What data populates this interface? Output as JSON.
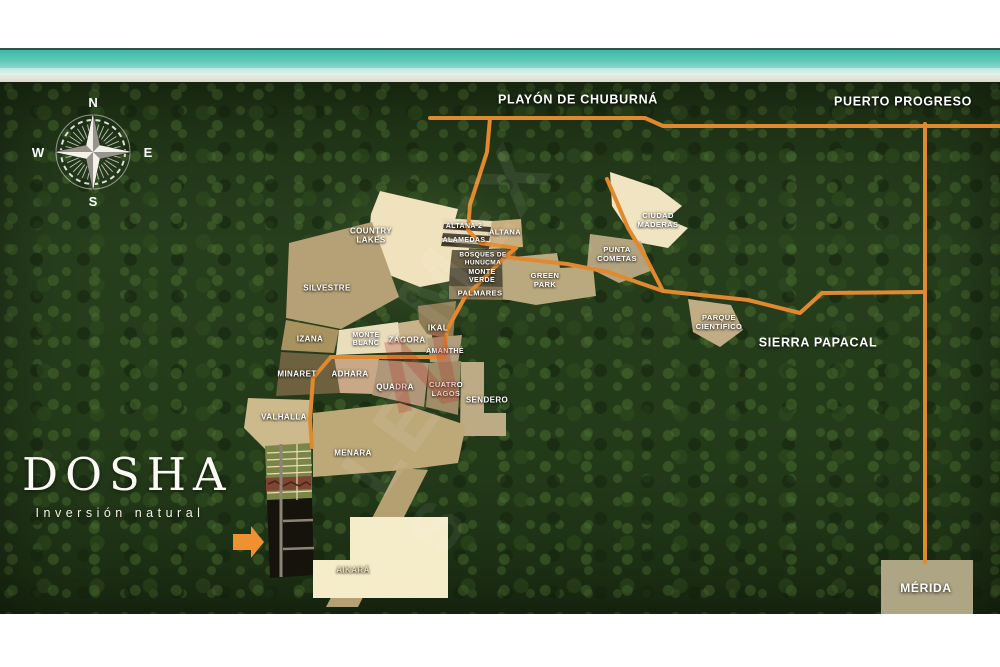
{
  "title": "DOSHA Inversión natural - master plan location map",
  "colors": {
    "road": "#e2892f",
    "arrow": "#ef9130",
    "label": "#ffffff",
    "ocean": "#4fc0b2",
    "forest": "#243a1b",
    "white_band": "#ffffff"
  },
  "compass": {
    "n": "N",
    "e": "E",
    "s": "S",
    "w": "W"
  },
  "logo": {
    "title": "DOSHA",
    "subtitle": "Inversión natural"
  },
  "region_labels": [
    {
      "id": "playon-de-chuburna",
      "text": "PLAYÓN DE CHUBURNÁ",
      "x": 578,
      "y": 100
    },
    {
      "id": "puerto-progreso",
      "text": "PUERTO PROGRESO",
      "x": 903,
      "y": 102
    },
    {
      "id": "sierra-papacal",
      "text": "SIERRA PAPACAL",
      "x": 818,
      "y": 343
    },
    {
      "id": "merida",
      "text": "MÉRIDA",
      "x": 926,
      "y": 588,
      "size": 12
    }
  ],
  "parcels": [
    {
      "id": "country-lakes",
      "lines": [
        "COUNTRY",
        "LAKES"
      ],
      "x": 371,
      "y": 236,
      "size": 8,
      "fill": "#efe2bd",
      "points": "380,191 458,209 451,235 469,248 466,278 420,287 366,266 371,214"
    },
    {
      "id": "altana-lots-base",
      "fill": "#e9dcba",
      "points": "443,218 492,221 490,249 441,247"
    },
    {
      "id": "altana-lot-row-1",
      "fill": "#46402e",
      "points": "444,224 491,227 490,232 443,229"
    },
    {
      "id": "altana-lot-row-2",
      "fill": "#46402e",
      "points": "443,233 490,236 489,241 442,238"
    },
    {
      "id": "altana-lot-row-3",
      "fill": "#46402e",
      "points": "442,242 490,245 489,249 441,246"
    },
    {
      "id": "altana-2",
      "text": "ALTANA 2",
      "x": 464,
      "y": 227,
      "size": 7
    },
    {
      "id": "alamedas",
      "text": "ALAMEDAS",
      "x": 464,
      "y": 241,
      "size": 7
    },
    {
      "id": "altana",
      "text": "ALTANA",
      "x": 505,
      "y": 233,
      "size": 7.5,
      "fill": "#c8ae7e",
      "points": "492,221 521,219 523,247 490,249"
    },
    {
      "id": "bosques-de-hunucma",
      "lines": [
        "BOSQUES DE",
        "HUNUCMA"
      ],
      "x": 483,
      "y": 259,
      "size": 6.5,
      "fill": "#6b5f45",
      "points": "452,250 516,250 514,268 450,268"
    },
    {
      "id": "monte-verde",
      "lines": [
        "MONTE",
        "VERDE"
      ],
      "x": 482,
      "y": 277,
      "size": 7,
      "fill": "#57503c",
      "points": "450,268 514,268 512,287 449,286"
    },
    {
      "id": "palmares",
      "text": "PALMARES",
      "x": 480,
      "y": 294,
      "size": 7.5,
      "fill": "#8a7b57",
      "points": "449,286 512,287 511,300 449,299"
    },
    {
      "id": "green-park",
      "lines": [
        "GREEN",
        "PARK"
      ],
      "x": 545,
      "y": 281,
      "size": 7.5,
      "fill": "#baa87e",
      "points": "502,258 557,253 560,268 593,266 596,296 536,305 503,299"
    },
    {
      "id": "ciudad-maderas",
      "lines": [
        "CIUDAD",
        "MADERAS"
      ],
      "x": 658,
      "y": 221,
      "size": 7.5,
      "fill": "#f0e4c2",
      "points": "610,172 658,188 682,206 667,219 688,228 668,248 636,242 612,206"
    },
    {
      "id": "punta-cometas",
      "lines": [
        "PUNTA",
        "COMETAS"
      ],
      "x": 617,
      "y": 255,
      "size": 7.5,
      "fill": "#c6b28c",
      "opacity": 0.88,
      "points": "590,234 641,241 653,270 619,283 587,267"
    },
    {
      "id": "parque-cientifico",
      "lines": [
        "PARQUE",
        "CIENTÍFICO"
      ],
      "x": 719,
      "y": 323,
      "size": 7.5,
      "fill": "#c1ad85",
      "points": "688,299 731,305 743,330 720,347 693,332"
    },
    {
      "id": "silvestre",
      "text": "SILVESTRE",
      "x": 327,
      "y": 288,
      "size": 8,
      "fill": "#b5a175",
      "points": "289,243 372,222 399,297 341,329 286,318"
    },
    {
      "id": "izana",
      "text": "IZANA",
      "x": 310,
      "y": 339,
      "size": 8,
      "fill": "#a8935f",
      "points": "286,320 339,330 334,353 281,350"
    },
    {
      "id": "monte-blanc",
      "lines": [
        "MONTE",
        "BLANC"
      ],
      "x": 366,
      "y": 340,
      "size": 7,
      "fill": "#e9ddbc",
      "points": "339,330 398,322 402,352 336,355"
    },
    {
      "id": "zagora",
      "text": "ZÁGORA",
      "x": 407,
      "y": 340,
      "size": 8,
      "fill": "#c7b28a",
      "points": "398,323 431,318 433,352 402,352"
    },
    {
      "id": "ikal",
      "text": "IKAL",
      "x": 438,
      "y": 328,
      "size": 8,
      "fill": "#8d7c55",
      "points": "418,306 456,301 453,340 427,334 419,322"
    },
    {
      "id": "amanthe",
      "text": "AMANTHÉ",
      "x": 445,
      "y": 352,
      "size": 7,
      "fill": "#b19e7c",
      "points": "427,338 462,335 458,364 430,362"
    },
    {
      "id": "minaret",
      "text": "MINARET",
      "x": 297,
      "y": 374,
      "size": 8,
      "fill": "#6e6140",
      "points": "281,352 334,355 340,393 276,396"
    },
    {
      "id": "adhara",
      "text": "ADHARA",
      "x": 350,
      "y": 374,
      "size": 8,
      "fill": "#c8a886",
      "points": "334,356 379,359 374,394 340,393"
    },
    {
      "id": "quadra",
      "text": "QUADRA",
      "x": 395,
      "y": 387,
      "size": 8,
      "fill": "#b0977a",
      "points": "379,360 429,363 424,407 372,395"
    },
    {
      "id": "cuatro-lagos",
      "lines": [
        "CUATRO",
        "LAGOS"
      ],
      "x": 446,
      "y": 390,
      "size": 7.5,
      "fill": "#a18d68",
      "points": "429,363 461,361 458,415 426,407"
    },
    {
      "id": "sendero",
      "text": "SENDERO",
      "x": 487,
      "y": 400,
      "size": 8,
      "fill": "#bcab85",
      "points": "461,362 484,362 484,413 506,413 506,436 460,436"
    },
    {
      "id": "valhalla",
      "text": "VALHALLA",
      "x": 284,
      "y": 417,
      "size": 8,
      "fill": "#ccb98c",
      "points": "248,398 310,400 312,447 268,452 244,428"
    },
    {
      "id": "menara",
      "text": "MENARA",
      "x": 353,
      "y": 453,
      "size": 8,
      "fill": "#bda878",
      "points": "313,413 400,403 466,425 458,463 404,470 313,477"
    },
    {
      "id": "menara-tail",
      "fill": "#b5a071",
      "points": "398,468 428,470 358,607 326,607"
    },
    {
      "id": "dosha-green-lots",
      "fill": "#7b8548",
      "points": "265,446 311,443 312,498 267,500"
    },
    {
      "id": "dosha-red-band",
      "fill": "#7d4532",
      "points": "266,478 311,476 311,489 266,491"
    },
    {
      "id": "dosha-black-lots",
      "fill": "#16130d",
      "points": "267,500 312,498 314,575 270,578"
    },
    {
      "id": "aikara",
      "text": "AIKARÁ",
      "x": 353,
      "y": 570,
      "size": 8,
      "color": "#ead9ae",
      "fill": "#f5ecca",
      "points": "350,517 448,517 448,598 313,598 313,560 350,560"
    },
    {
      "id": "merida-box",
      "fill": "#aea584",
      "points": "881,560 973,560 973,614 881,614"
    }
  ],
  "roads": [
    {
      "points": "430,118 645,118 663,126 1000,126",
      "w": 4
    },
    {
      "points": "925,124 925,562",
      "w": 4
    },
    {
      "points": "490,118 487,152 470,205 468,230 480,243 516,248",
      "w": 4
    },
    {
      "points": "607,179 628,228 646,258 663,291",
      "w": 4
    },
    {
      "points": "516,248 505,257 465,297 447,330 444,357 331,357 313,378 310,420 312,447",
      "w": 4
    },
    {
      "points": "505,257 567,264 608,272 663,291 748,300 800,313 822,293 924,292",
      "w": 4
    }
  ],
  "detail_lines": [
    {
      "points": "267,453 311,451",
      "stroke": "#e9deb6",
      "w": 1.2
    },
    {
      "points": "267,460 311,458",
      "stroke": "#e9deb6",
      "w": 1.2
    },
    {
      "points": "267,467 312,465",
      "stroke": "#e9deb6",
      "w": 1.2
    },
    {
      "points": "267,474 312,472",
      "stroke": "#e9deb6",
      "w": 1.2
    },
    {
      "points": "267,493 312,491",
      "stroke": "#e9deb6",
      "w": 1.2
    },
    {
      "points": "297,444 297,500",
      "stroke": "#e9deb6",
      "w": 1.2
    },
    {
      "points": "268,484 275,481 283,486 291,482 299,486 306,482 311,485",
      "stroke": "#4a241a",
      "w": 1.6
    },
    {
      "points": "281,444 281,577",
      "stroke": "#8b8477",
      "w": 3
    },
    {
      "points": "283,521 313,520",
      "stroke": "#8b8477",
      "w": 2.5
    },
    {
      "points": "283,549 314,548",
      "stroke": "#8b8477",
      "w": 2.5
    }
  ],
  "arrow_points": "233,534 251,534 251,526 264,542 251,558 251,550 233,550",
  "watermark": {
    "fragments": [
      {
        "text": "MEX",
        "x": 475,
        "y": 235,
        "size": 85,
        "color": "#ffffff",
        "opacity": 0.07,
        "rot": -55
      },
      {
        "text": "N",
        "x": 425,
        "y": 372,
        "size": 105,
        "color": "#b5372a",
        "opacity": 0.28,
        "rot": -12
      },
      {
        "text": "LE",
        "x": 392,
        "y": 440,
        "size": 78,
        "color": "#ffffff",
        "opacity": 0.07,
        "rot": -55
      },
      {
        "text": "S",
        "x": 438,
        "y": 525,
        "size": 70,
        "color": "#ffffff",
        "opacity": 0.06,
        "rot": -55
      }
    ]
  }
}
